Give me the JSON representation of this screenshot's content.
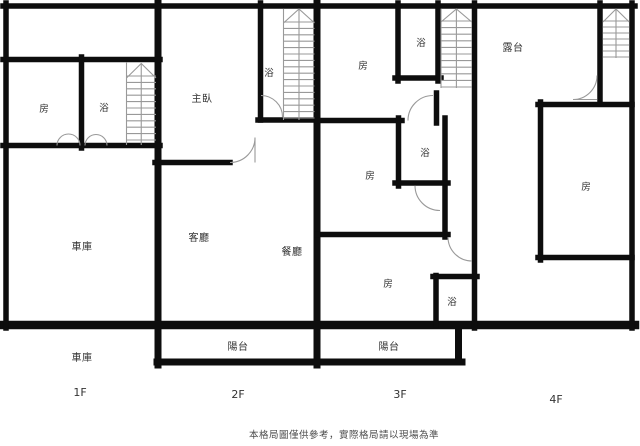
{
  "colors": {
    "wall": "#0d0d0d",
    "thin_line": "#999999",
    "label": "#333333",
    "note": "#4d4d4d",
    "bg": "#ffffff"
  },
  "disclaimer": "本格局圖僅供參考，實際格局請以現場為準",
  "floors": [
    {
      "name": "1F",
      "floor_label": "1F",
      "annotation": "車庫",
      "rooms": [
        {
          "label": "房"
        },
        {
          "label": "浴"
        },
        {
          "label": "車庫"
        }
      ]
    },
    {
      "name": "2F",
      "floor_label": "2F",
      "rooms": [
        {
          "label": "主臥"
        },
        {
          "label": "浴"
        },
        {
          "label": "客廳"
        },
        {
          "label": "餐廳"
        },
        {
          "label": "陽台"
        }
      ]
    },
    {
      "name": "3F",
      "floor_label": "3F",
      "rooms": [
        {
          "label": "房"
        },
        {
          "label": "浴"
        },
        {
          "label": "房"
        },
        {
          "label": "浴"
        },
        {
          "label": "房"
        },
        {
          "label": "浴"
        },
        {
          "label": "陽台"
        }
      ]
    },
    {
      "name": "4F",
      "floor_label": "4F",
      "rooms": [
        {
          "label": "露台"
        },
        {
          "label": "房"
        }
      ]
    }
  ]
}
